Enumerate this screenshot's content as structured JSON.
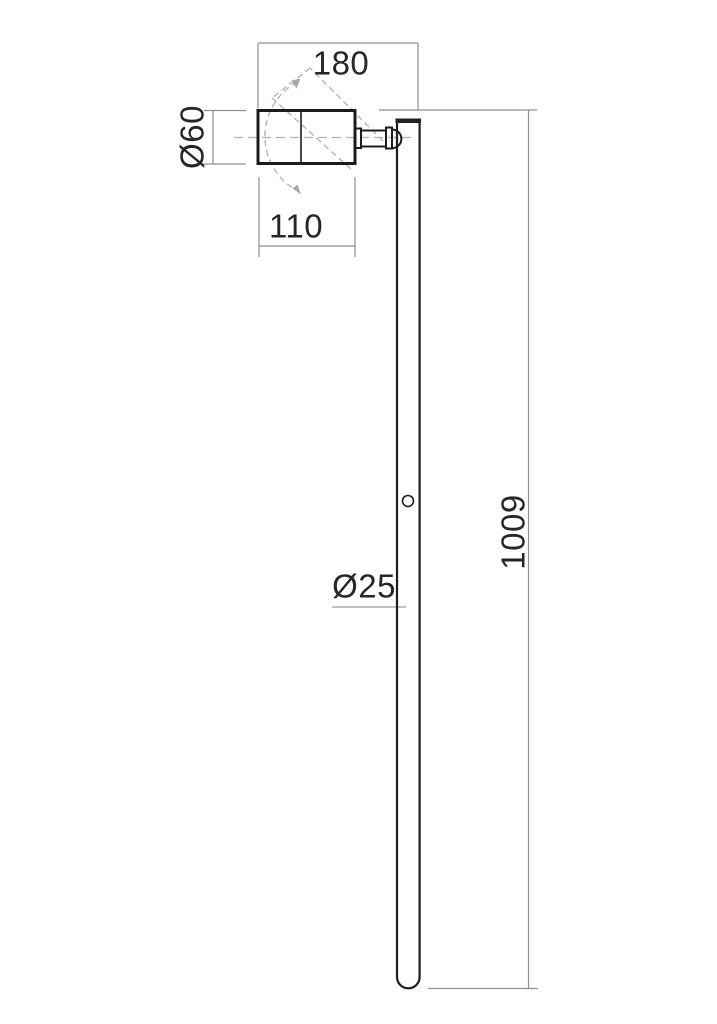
{
  "drawing": {
    "description": "technical dimension drawing of adjustable pole spotlight, side view",
    "labels": {
      "head_span": "180",
      "head_diameter": "Ø60",
      "head_length": "110",
      "pole_diameter": "Ø25",
      "pole_height": "1009"
    },
    "colors": {
      "background": "#ffffff",
      "part_outline": "#1c1c1c",
      "dimension_lines": "#8f8f8f",
      "dashed_motion_lines": "#b0b0b0",
      "text": "#262626"
    }
  }
}
